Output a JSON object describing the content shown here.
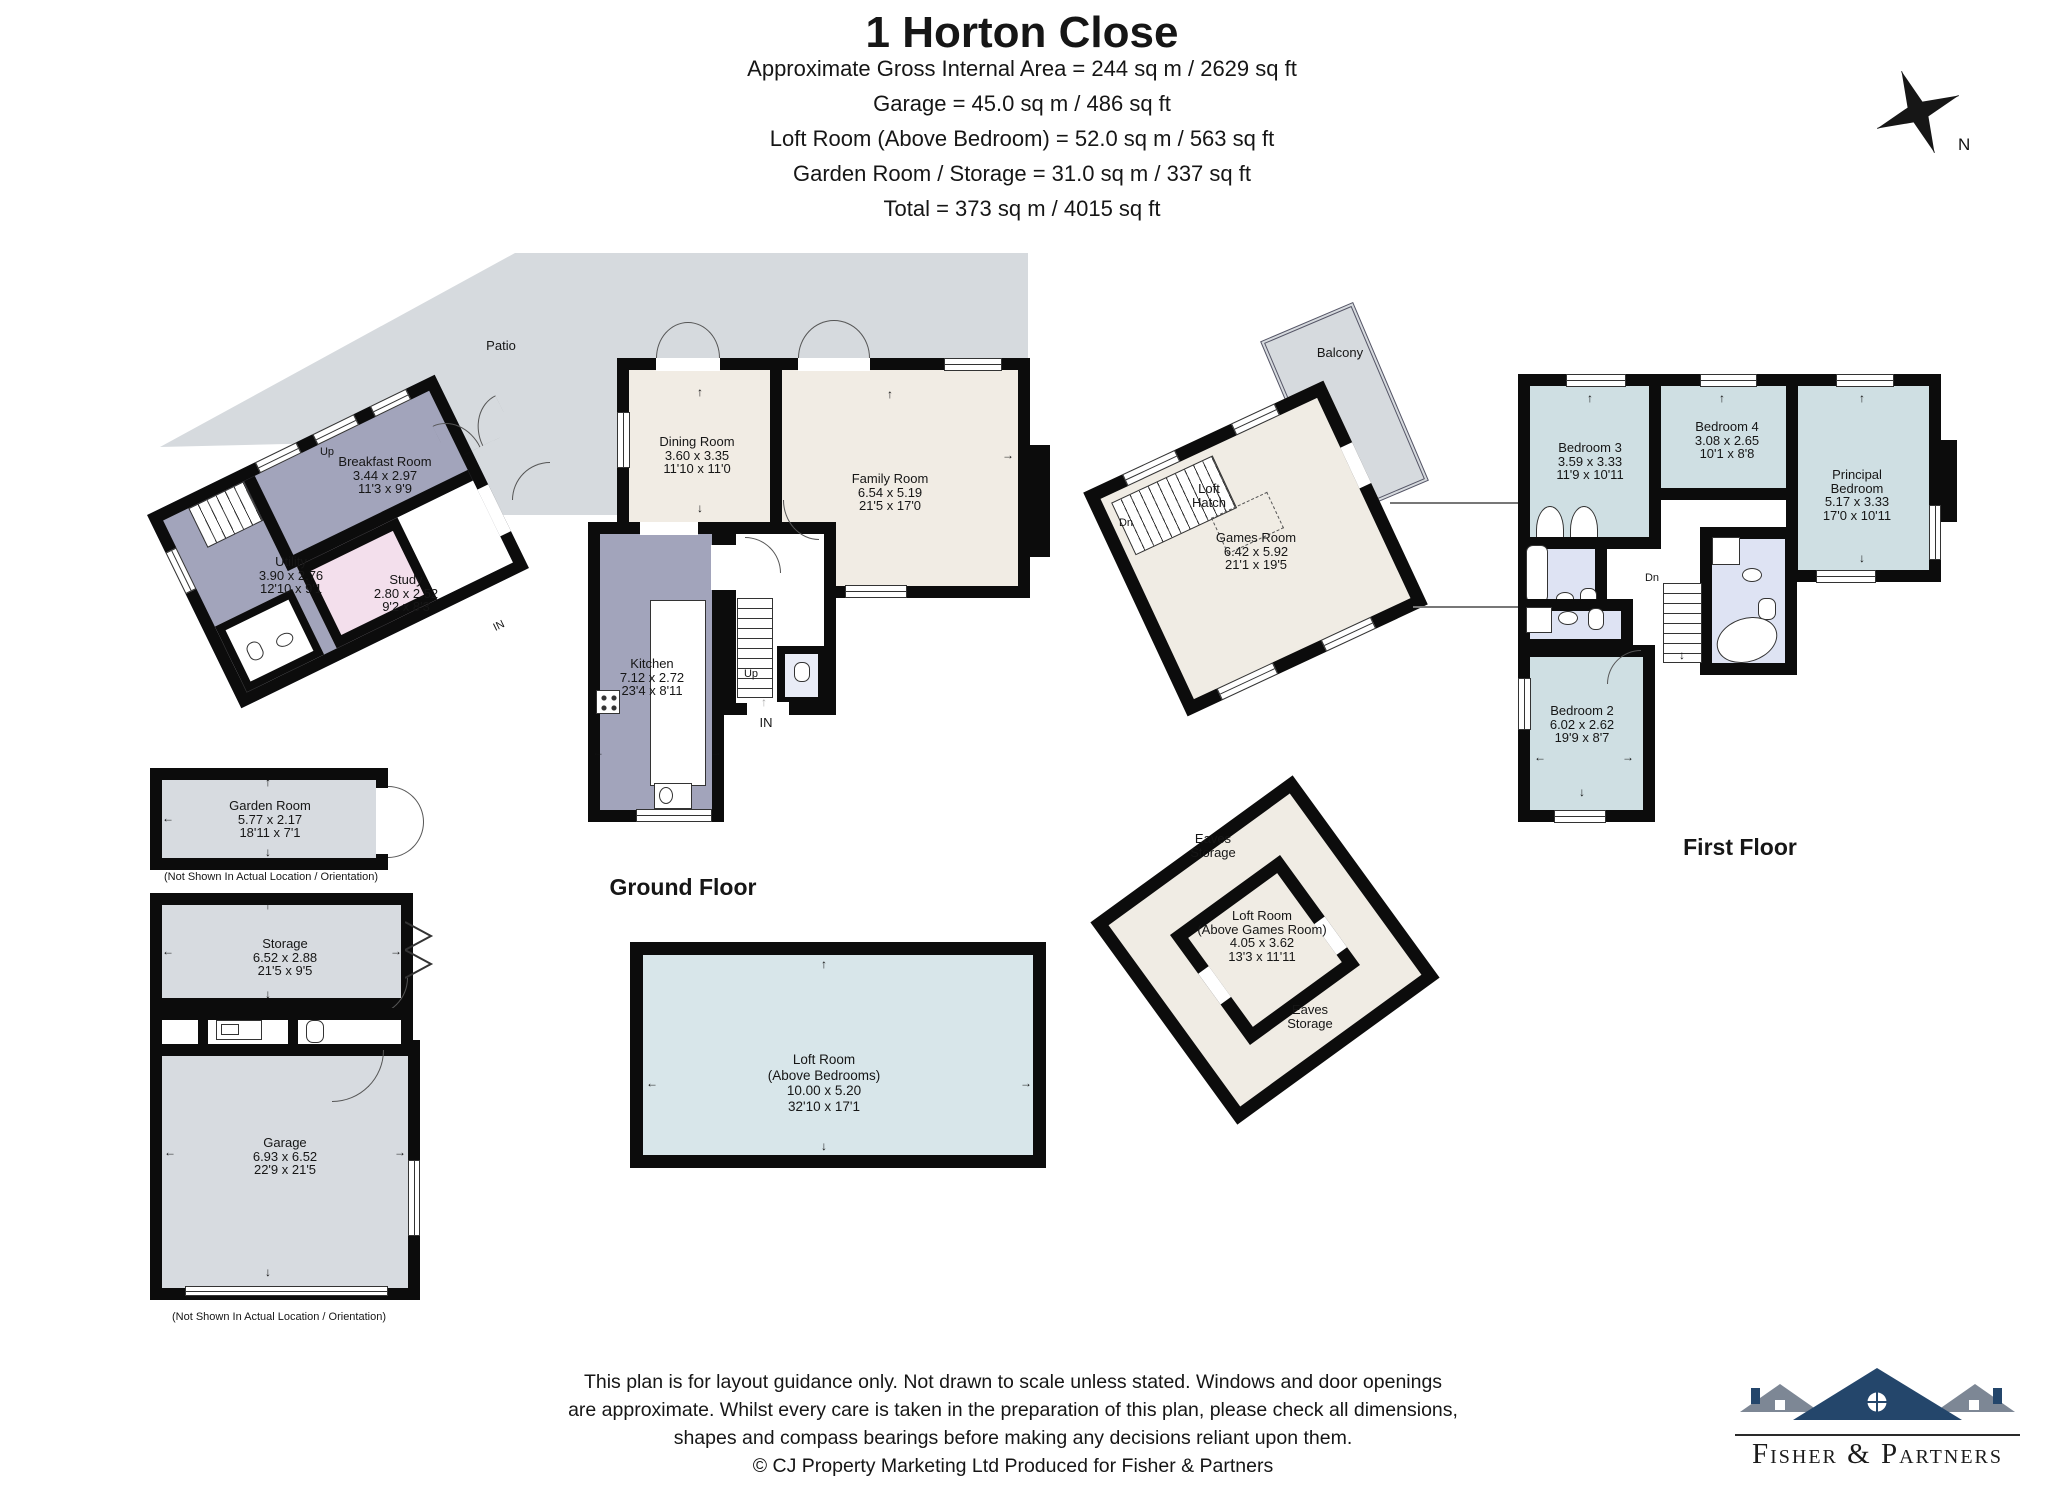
{
  "header": {
    "title": "1 Horton Close",
    "lines": [
      "Approximate Gross Internal Area = 244 sq m / 2629 sq ft",
      "Garage = 45.0 sq m / 486 sq ft",
      "Loft Room (Above Bedroom) = 52.0 sq m / 563 sq ft",
      "Garden Room / Storage = 31.0 sq m / 337 sq ft",
      "Total = 373 sq m / 4015 sq ft"
    ]
  },
  "compass": {
    "north_label": "N"
  },
  "floors": {
    "ground": "Ground Floor",
    "first": "First Floor"
  },
  "rooms": {
    "patio": {
      "lines": [
        "Patio"
      ]
    },
    "breakfast": {
      "lines": [
        "Breakfast Room",
        "3.44 x 2.97",
        "11'3 x 9'9"
      ]
    },
    "utility": {
      "lines": [
        "Utility",
        "3.90 x 2.76",
        "12'10 x 9'1"
      ]
    },
    "study": {
      "lines": [
        "Study",
        "2.80 x 2.52",
        "9'2 x 8'3"
      ]
    },
    "dining": {
      "lines": [
        "Dining Room",
        "3.60 x 3.35",
        "11'10 x 11'0"
      ]
    },
    "family": {
      "lines": [
        "Family Room",
        "6.54 x 5.19",
        "21'5 x 17'0"
      ]
    },
    "kitchen": {
      "lines": [
        "Kitchen",
        "7.12 x 2.72",
        "23'4 x 8'11"
      ]
    },
    "games": {
      "lines": [
        "Games Room",
        "6.42 x 5.92",
        "21'1 x 19'5"
      ]
    },
    "balcony": {
      "lines": [
        "Balcony"
      ]
    },
    "loft_hatch": {
      "lines": [
        "Loft",
        "Hatch"
      ]
    },
    "bedroom3": {
      "lines": [
        "Bedroom 3",
        "3.59 x 3.33",
        "11'9 x 10'11"
      ]
    },
    "bedroom4": {
      "lines": [
        "Bedroom 4",
        "3.08 x 2.65",
        "10'1 x 8'8"
      ]
    },
    "principal": {
      "lines": [
        "Principal",
        "Bedroom",
        "5.17 x 3.33",
        "17'0 x 10'11"
      ]
    },
    "bedroom2": {
      "lines": [
        "Bedroom 2",
        "6.02 x 2.62",
        "19'9 x 8'7"
      ]
    },
    "garden": {
      "lines": [
        "Garden Room",
        "5.77 x 2.17",
        "18'11 x 7'1"
      ]
    },
    "storage": {
      "lines": [
        "Storage",
        "6.52 x 2.88",
        "21'5 x 9'5"
      ]
    },
    "garage": {
      "lines": [
        "Garage",
        "6.93 x 6.52",
        "22'9 x 21'5"
      ]
    },
    "loft_bedrooms": {
      "lines": [
        "Loft Room",
        "(Above Bedrooms)",
        "10.00 x 5.20",
        "32'10 x 17'1"
      ]
    },
    "loft_games": {
      "lines": [
        "Loft Room",
        "(Above Games Room)",
        "4.05 x 3.62",
        "13'3 x 11'11"
      ]
    },
    "eaves": {
      "lines": [
        "Eaves",
        "Storage"
      ]
    }
  },
  "annotations": {
    "up": "Up",
    "dn": "Dn",
    "in_label": "IN",
    "not_shown": "(Not Shown In Actual Location / Orientation)"
  },
  "glyphs": {
    "up": "↑",
    "down": "↓",
    "left": "←",
    "right": "→"
  },
  "footer": {
    "lines": [
      "This plan is for layout guidance only. Not drawn to scale unless stated. Windows and door openings",
      "are approximate. Whilst every care is taken in the preparation of this plan, please check all dimensions,",
      "shapes and compass bearings before making any decisions reliant upon them.",
      "© CJ Property Marketing Ltd Produced for Fisher & Partners"
    ]
  },
  "logo": {
    "name": "Fisher & Partners"
  },
  "colors": {
    "wall": "#0c0c0c",
    "patio": "#d6dade",
    "cream": "#f1ece4",
    "purple": "#a2a4bb",
    "pink": "#f3dfec",
    "bedroom_blue": "#cfdfe3",
    "bathroom_lavender": "#dee3f3",
    "loft_blue": "#d8e6ea",
    "games_cream": "#f0ece4",
    "outbuilding_grey": "#d7dbe0",
    "logo_navy": "#24466b"
  }
}
